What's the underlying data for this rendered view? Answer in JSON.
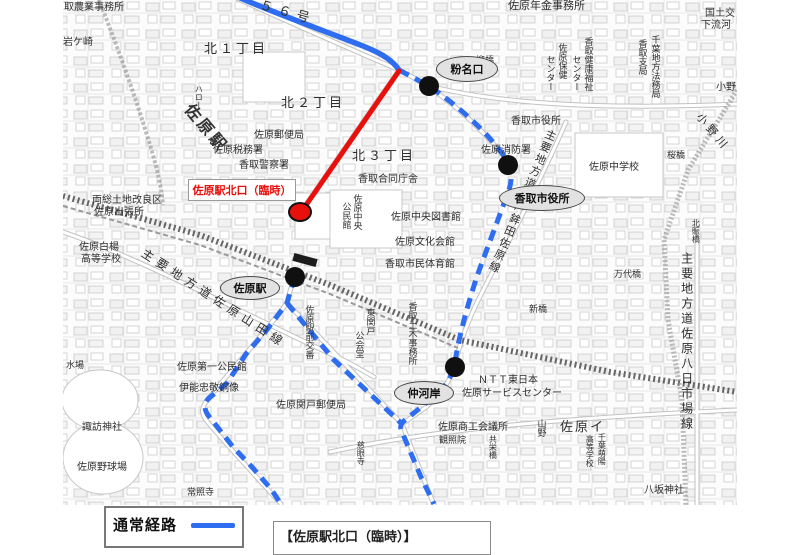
{
  "map": {
    "route_colors": {
      "normal": "#2f6df0",
      "temporary": "#e8100c"
    },
    "routes": {
      "normal_solid": "M236,-4 C266,10 330,33 363,46 C383,54 393,61 399,70",
      "normal_dashed": "M399,70 L429,86 C470,114 496,143 509,163 C512,172 512,180 509,190 L480,268 C472,290 460,330 455,362 C452,377 446,386 436,395 L404,421 C400,424 400,428 402,432 L421,477 L434,504 M295,277 L290,293 L287,303 L266,331 L246,354 L227,383 L208,399 C204,404 204,409 208,415 L233,447 L252,467 L271,489 L281,504 M287,303 L334,360 L402,424",
      "temporary": "M399,71 L302,211"
    },
    "stops": [
      {
        "x": 429,
        "y": 86
      },
      {
        "x": 508,
        "y": 165
      },
      {
        "x": 295,
        "y": 277
      },
      {
        "x": 455,
        "y": 367
      }
    ],
    "temp_stop": {
      "label": "佐原駅北口（臨時）",
      "x": 300,
      "y": 212
    },
    "ovals": [
      {
        "t": "粉名口",
        "x": 467,
        "y": 69,
        "rx": 31,
        "ry": 13
      },
      {
        "t": "佐原駅",
        "x": 250,
        "y": 288,
        "rx": 30,
        "ry": 12
      },
      {
        "t": "香取市役所",
        "x": 542,
        "y": 198,
        "rx": 43,
        "ry": 13
      },
      {
        "t": "仲河岸",
        "x": 424,
        "y": 393,
        "rx": 30,
        "ry": 12
      }
    ],
    "labels": [
      {
        "t": "取農業事務所",
        "x": 64,
        "y": 3,
        "s": 10
      },
      {
        "t": "佐原年金事務所",
        "x": 508,
        "y": 1,
        "s": 11
      },
      {
        "t": "国土交",
        "x": 705,
        "y": 9,
        "s": 10
      },
      {
        "t": "下流河",
        "x": 701,
        "y": 21,
        "s": 10
      },
      {
        "t": "岩ケ崎",
        "x": 63,
        "y": 38,
        "s": 10
      },
      {
        "t": "北１丁目",
        "x": 204,
        "y": 42,
        "s": 13,
        "ls": 3
      },
      {
        "t": "北２丁目",
        "x": 281,
        "y": 96,
        "s": 13,
        "ls": 3
      },
      {
        "t": "北３丁目",
        "x": 352,
        "y": 149,
        "s": 13,
        "ls": 3
      },
      {
        "t": "５６号",
        "x": 262,
        "y": -2,
        "s": 13,
        "r": 16,
        "ls": 6
      },
      {
        "t": "柳橋",
        "x": 476,
        "y": 56,
        "s": 9
      },
      {
        "t": "香取市役所",
        "x": 511,
        "y": 117,
        "s": 10
      },
      {
        "t": "佐原中学校",
        "x": 589,
        "y": 163,
        "s": 10
      },
      {
        "t": "桜橋",
        "x": 667,
        "y": 151,
        "s": 9
      },
      {
        "t": "佐原郵便局",
        "x": 254,
        "y": 131,
        "s": 10
      },
      {
        "t": "佐原税務署",
        "x": 213,
        "y": 146,
        "s": 10
      },
      {
        "t": "香取警察署",
        "x": 239,
        "y": 161,
        "s": 10
      },
      {
        "t": "香取合同庁舎",
        "x": 358,
        "y": 175,
        "s": 10
      },
      {
        "t": "佐原消防署",
        "x": 481,
        "y": 146,
        "s": 10
      },
      {
        "t": "佐原中央図書館",
        "x": 391,
        "y": 213,
        "s": 10
      },
      {
        "t": "佐原文化会館",
        "x": 395,
        "y": 238,
        "s": 10
      },
      {
        "t": "香取市民体育館",
        "x": 385,
        "y": 260,
        "s": 10
      },
      {
        "t": "両総土地改良区",
        "x": 92,
        "y": 196,
        "s": 10
      },
      {
        "t": "佐原出張所",
        "x": 94,
        "y": 208,
        "s": 10
      },
      {
        "t": "佐原白楊",
        "x": 79,
        "y": 243,
        "s": 10
      },
      {
        "t": "高等学校",
        "x": 81,
        "y": 255,
        "s": 10
      },
      {
        "t": "水場",
        "x": 66,
        "y": 361,
        "s": 9
      },
      {
        "t": "諏訪神社",
        "x": 82,
        "y": 423,
        "s": 10
      },
      {
        "t": "佐原野球場",
        "x": 77,
        "y": 463,
        "s": 10
      },
      {
        "t": "佐原第一公民館",
        "x": 177,
        "y": 363,
        "s": 10
      },
      {
        "t": "伊能忠敬銅像",
        "x": 179,
        "y": 384,
        "s": 10
      },
      {
        "t": "佐原関戸郵便局",
        "x": 276,
        "y": 401,
        "s": 10
      },
      {
        "t": "常照寺",
        "x": 187,
        "y": 488,
        "s": 9
      },
      {
        "t": "佐原商工会議所",
        "x": 438,
        "y": 423,
        "s": 10
      },
      {
        "t": "観照院",
        "x": 439,
        "y": 436,
        "s": 9
      },
      {
        "t": "ＮＴＴ東日本",
        "x": 478,
        "y": 376,
        "s": 10
      },
      {
        "t": "佐原サービスセンター",
        "x": 462,
        "y": 389,
        "s": 10
      },
      {
        "t": "新橋",
        "x": 529,
        "y": 305,
        "s": 9
      },
      {
        "t": "万代橋",
        "x": 614,
        "y": 270,
        "s": 9
      },
      {
        "t": "佐原イ",
        "x": 560,
        "y": 420,
        "s": 13,
        "ls": 2
      },
      {
        "t": "八坂神社",
        "x": 644,
        "y": 486,
        "s": 10
      },
      {
        "t": "小野",
        "x": 716,
        "y": 83,
        "s": 10
      },
      {
        "t": "小野川",
        "x": 702,
        "y": 112,
        "s": 11,
        "r": 50,
        "ls": 4
      },
      {
        "t": "佐原駅",
        "x": 193,
        "y": 102,
        "s": 16,
        "r": 50,
        "ls": 3,
        "w": 700,
        "c": "#333333"
      },
      {
        "t": "主要地方道佐原山田線",
        "x": 146,
        "y": 247,
        "s": 12,
        "r": 33,
        "ls": 5
      },
      {
        "t": "主要地方道水戸鉾田佐原線",
        "x": 546,
        "y": 127,
        "s": 11,
        "v": 1,
        "r": 23,
        "ls": 2
      },
      {
        "t": "主要地方道佐原八日市場線",
        "x": 680,
        "y": 252,
        "s": 12,
        "v": 1,
        "ls": 3
      },
      {
        "t": "佐原駅前交番",
        "x": 304,
        "y": 305,
        "s": 9,
        "v": 1
      },
      {
        "t": "東関戸",
        "x": 365,
        "y": 308,
        "s": 9,
        "v": 1
      },
      {
        "t": "公会堂",
        "x": 354,
        "y": 331,
        "s": 9,
        "v": 1
      },
      {
        "t": "香取土木事務所",
        "x": 407,
        "y": 302,
        "s": 9,
        "v": 1
      },
      {
        "t": "香取支局",
        "x": 637,
        "y": 39,
        "s": 9,
        "v": 1
      },
      {
        "t": "千葉地方法務局",
        "x": 650,
        "y": 35,
        "s": 9,
        "v": 1
      },
      {
        "t": "佐原保健",
        "x": 557,
        "y": 43,
        "s": 9,
        "v": 1
      },
      {
        "t": "センター",
        "x": 545,
        "y": 55,
        "s": 9,
        "v": 1
      },
      {
        "t": "香取健康福祉",
        "x": 583,
        "y": 37,
        "s": 9,
        "v": 1
      },
      {
        "t": "センター",
        "x": 571,
        "y": 55,
        "s": 9,
        "v": 1
      },
      {
        "t": "山野",
        "x": 536,
        "y": 419,
        "s": 9,
        "v": 1
      },
      {
        "t": "共栄橋",
        "x": 488,
        "y": 435,
        "s": 8,
        "v": 1
      },
      {
        "t": "慈眼寺",
        "x": 356,
        "y": 441,
        "s": 8,
        "v": 1
      },
      {
        "t": "北賑橋",
        "x": 691,
        "y": 219,
        "s": 8,
        "v": 1
      },
      {
        "t": "千葉萌陽",
        "x": 597,
        "y": 433,
        "s": 8,
        "v": 1
      },
      {
        "t": "高等学校",
        "x": 585,
        "y": 435,
        "s": 8,
        "v": 1
      },
      {
        "t": "佐原中央",
        "x": 352,
        "y": 194,
        "s": 9,
        "v": 1
      },
      {
        "t": "公民館",
        "x": 341,
        "y": 202,
        "s": 9,
        "v": 1
      },
      {
        "t": "ハロー",
        "x": 194,
        "y": 85,
        "s": 8,
        "v": 1
      }
    ]
  },
  "legend": {
    "normal_route": "通常経路",
    "notice_partial": "【佐原駅北口（臨時）】"
  }
}
